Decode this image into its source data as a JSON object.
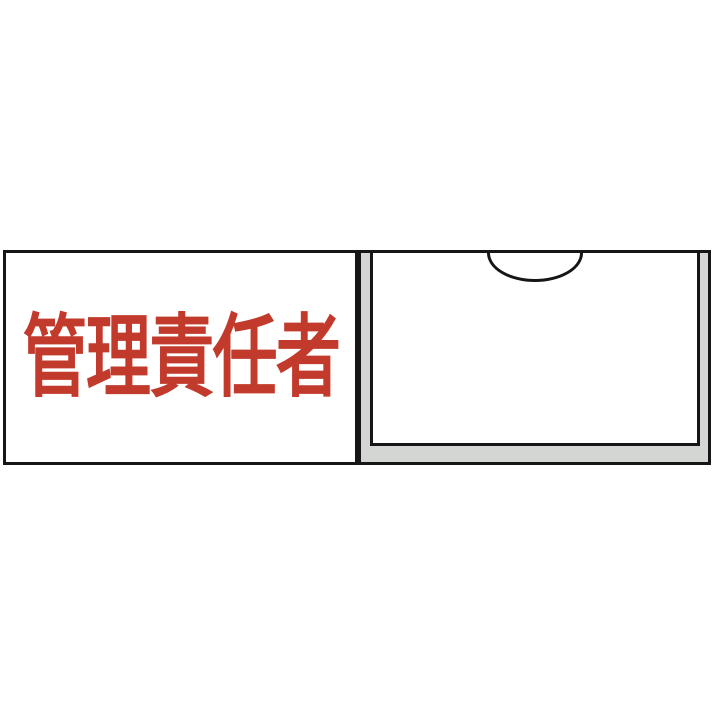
{
  "sign": {
    "plate_label": "管理責任者",
    "colors": {
      "label_red": "#c23a2c",
      "frame_gray": "#d4d6d4",
      "outline": "#161616",
      "surface_white": "#ffffff"
    }
  }
}
